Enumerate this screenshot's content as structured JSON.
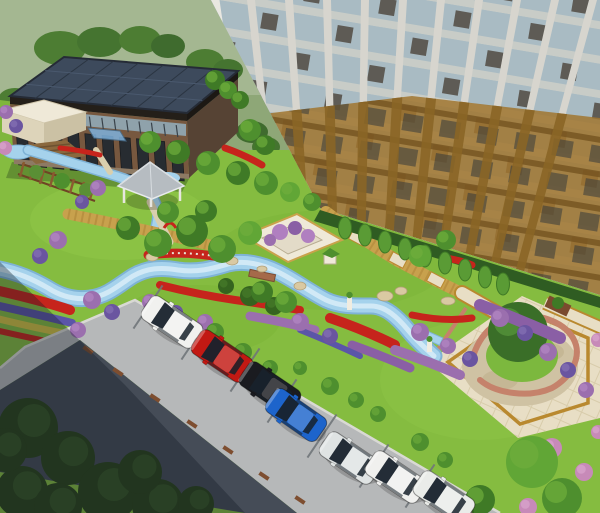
{
  "scene": {
    "title": "Residential courtyard landscape — aerial 3D rendering",
    "type": "3d-architectural-visualization",
    "palette": {
      "field": "#93ab7c",
      "fieldHaze": "#aebd9d",
      "lawn": "#85bc40",
      "lawnLight": "#95ca4f",
      "lawnDark": "#74ad35",
      "streamWater": "#a5d2ec",
      "streamDeep": "#7fb3d6",
      "streamCore": "#d8edf8",
      "roadLight": "#b6b8b9",
      "asphalt": "#454c57",
      "curb": "#d9d9d4",
      "darkTrees": "#22351f",
      "hedge": "#2f5c22",
      "flowerRed": "#c6241c",
      "flowerPurple": "#9b6fae",
      "flowerViolet": "#5b55a8",
      "flowerPink": "#c78ab8",
      "flowerYellow": "#d3c342",
      "boardwalk": "#c8a14d",
      "pavingCream": "#e8dec5",
      "pavingTrim": "#b9892f",
      "plazaStone": "#cfc2a3",
      "plazaWall": "#c5826b",
      "plazaLawn": "#7cb83e",
      "stone": "#d9c9a2",
      "towerPier": "#d7d5ce",
      "towerWhiteEdge": "#e9e7e1",
      "towerGlass": "#a9bbc3",
      "towerSpandrel": "#453b30",
      "towerBrick": "#a1762f",
      "towerBrickDark": "#74521f",
      "officeBrick": "#77583f",
      "officeRoof": "#3d4a5c",
      "officeWindow": "#272c31",
      "clerestory": "#8fa2ab",
      "canopyBlue": "#7fb2dd",
      "gazeboRoof": "#b6bcc1",
      "structureWhite": "#efe9d8",
      "soilBed": "#8a683e",
      "shadow": "#141c26"
    },
    "buildings": {
      "tower": {
        "name": "high-rise residential tower",
        "bays": 10,
        "style": "glass piers with amber brick base"
      },
      "office": {
        "name": "low-rise office building",
        "roof": "solar panel array",
        "entrance": "blue glass canopy"
      },
      "annex": {
        "name": "small flat-roof annex building"
      },
      "gazebo": {
        "name": "garden gazebo with gray pyramidal roof"
      },
      "pergola": {
        "name": "wooden pergola trellis"
      }
    },
    "vehicles": [
      {
        "name": "white-hatchback",
        "color": "#f1f1ef",
        "x": 172,
        "y": 322,
        "angle": 34
      },
      {
        "name": "red-sedan",
        "color": "#c21913",
        "x": 222,
        "y": 356,
        "angle": 34
      },
      {
        "name": "black-sedan",
        "color": "#1a1b20",
        "x": 270,
        "y": 388,
        "angle": 34
      },
      {
        "name": "blue-sedan",
        "color": "#1d64cb",
        "x": 296,
        "y": 415,
        "angle": 35
      },
      {
        "name": "silver-suv",
        "color": "#dfe3e3",
        "x": 350,
        "y": 458,
        "angle": 34
      },
      {
        "name": "white-sedan",
        "color": "#f0f0ee",
        "x": 396,
        "y": 477,
        "angle": 34
      },
      {
        "name": "white-suv",
        "color": "#eaece9",
        "x": 444,
        "y": 497,
        "angle": 34
      }
    ],
    "landscape": {
      "trees": [
        [
          150,
          142,
          11,
          0
        ],
        [
          178,
          152,
          12,
          1
        ],
        [
          208,
          163,
          12,
          0
        ],
        [
          238,
          173,
          12,
          1
        ],
        [
          266,
          183,
          12,
          0
        ],
        [
          128,
          228,
          12,
          1
        ],
        [
          158,
          243,
          14,
          0
        ],
        [
          192,
          231,
          16,
          1
        ],
        [
          222,
          249,
          14,
          0
        ],
        [
          250,
          233,
          12,
          2
        ],
        [
          206,
          211,
          11,
          1
        ],
        [
          168,
          212,
          11,
          0
        ],
        [
          290,
          192,
          10,
          2
        ],
        [
          312,
          202,
          9,
          0
        ],
        [
          262,
          292,
          11,
          1
        ],
        [
          286,
          302,
          11,
          0
        ],
        [
          420,
          256,
          11,
          2
        ],
        [
          446,
          240,
          10,
          0
        ],
        [
          532,
          462,
          26,
          2
        ],
        [
          562,
          498,
          20,
          0
        ],
        [
          480,
          500,
          15,
          1
        ],
        [
          215,
          80,
          10,
          1
        ],
        [
          228,
          90,
          9,
          0
        ],
        [
          240,
          100,
          9,
          1
        ],
        [
          250,
          130,
          11,
          0
        ],
        [
          265,
          145,
          10,
          1
        ]
      ],
      "columnTrees": [
        [
          345,
          228
        ],
        [
          365,
          235
        ],
        [
          385,
          242
        ],
        [
          405,
          249
        ],
        [
          425,
          256
        ],
        [
          445,
          263
        ],
        [
          465,
          270
        ],
        [
          485,
          277
        ],
        [
          503,
          284
        ]
      ],
      "darkTrees": [
        [
          28,
          428,
          30
        ],
        [
          68,
          458,
          27
        ],
        [
          22,
          492,
          26
        ],
        [
          108,
          492,
          30
        ],
        [
          158,
          505,
          26
        ],
        [
          58,
          507,
          24
        ],
        [
          140,
          472,
          22
        ],
        [
          196,
          504,
          18
        ],
        [
          5,
          450,
          22
        ]
      ],
      "bushes": [
        [
          58,
          240,
          9,
          "p"
        ],
        [
          40,
          256,
          8,
          "v"
        ],
        [
          92,
          300,
          9,
          "p"
        ],
        [
          112,
          312,
          8,
          "v"
        ],
        [
          78,
          330,
          8,
          "p"
        ],
        [
          150,
          302,
          8,
          "p"
        ],
        [
          176,
          312,
          7,
          "v"
        ],
        [
          205,
          322,
          8,
          "p"
        ],
        [
          300,
          322,
          9,
          "p"
        ],
        [
          330,
          336,
          8,
          "v"
        ],
        [
          420,
          332,
          9,
          "p"
        ],
        [
          448,
          346,
          8,
          "p"
        ],
        [
          470,
          359,
          8,
          "v"
        ],
        [
          500,
          318,
          9,
          "p"
        ],
        [
          525,
          333,
          8,
          "v"
        ],
        [
          548,
          352,
          9,
          "p"
        ],
        [
          568,
          370,
          8,
          "v"
        ],
        [
          586,
          390,
          8,
          "p"
        ],
        [
          552,
          448,
          10,
          "k"
        ],
        [
          584,
          472,
          9,
          "k"
        ],
        [
          598,
          432,
          7,
          "k"
        ],
        [
          528,
          507,
          9,
          "k"
        ],
        [
          468,
          507,
          8,
          "k"
        ],
        [
          598,
          340,
          7,
          "k"
        ],
        [
          215,
          332,
          9,
          "g"
        ],
        [
          243,
          352,
          9,
          "g"
        ],
        [
          270,
          368,
          8,
          "g"
        ],
        [
          330,
          386,
          9,
          "g"
        ],
        [
          356,
          400,
          8,
          "g"
        ],
        [
          378,
          414,
          8,
          "g"
        ],
        [
          300,
          368,
          7,
          "g"
        ],
        [
          420,
          442,
          9,
          "g"
        ],
        [
          445,
          460,
          8,
          "g"
        ],
        [
          250,
          296,
          10,
          "d"
        ],
        [
          274,
          306,
          9,
          "d"
        ],
        [
          226,
          286,
          8,
          "d"
        ],
        [
          98,
          188,
          8,
          "p"
        ],
        [
          82,
          202,
          7,
          "v"
        ],
        [
          6,
          112,
          7,
          "p"
        ],
        [
          16,
          126,
          7,
          "v"
        ],
        [
          5,
          148,
          7,
          "k"
        ]
      ],
      "boulders": [
        [
          218,
          255,
          8,
          5
        ],
        [
          232,
          261,
          6,
          4
        ],
        [
          385,
          296,
          8,
          5
        ],
        [
          401,
          291,
          6,
          4
        ],
        [
          448,
          301,
          7,
          4
        ],
        [
          262,
          269,
          5,
          3
        ],
        [
          300,
          286,
          6,
          4
        ],
        [
          152,
          257,
          6,
          4
        ]
      ],
      "stallLines": [
        [
          148,
          307
        ],
        [
          196,
          338
        ],
        [
          245,
          370
        ],
        [
          282,
          401
        ],
        [
          322,
          436
        ],
        [
          374,
          466
        ],
        [
          420,
          486
        ]
      ],
      "wheelStops": [
        [
          88,
          350
        ],
        [
          118,
          372
        ],
        [
          155,
          398
        ],
        [
          192,
          424
        ],
        [
          228,
          450
        ],
        [
          264,
          476
        ],
        [
          300,
          500
        ]
      ]
    }
  }
}
